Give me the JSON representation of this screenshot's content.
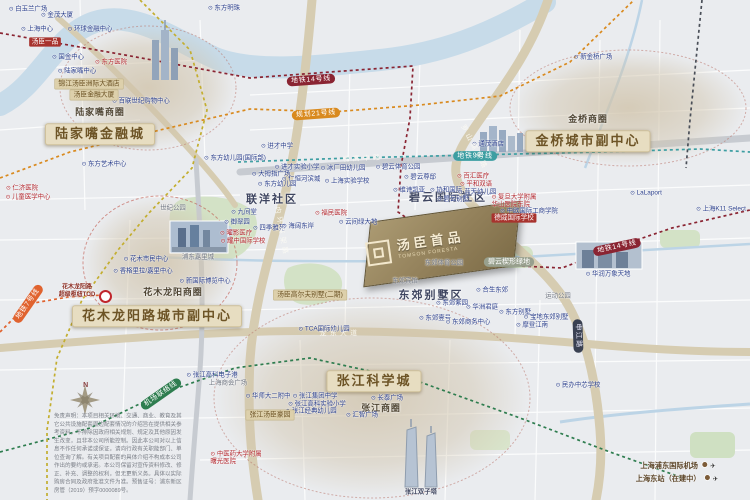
{
  "project": {
    "name_cn": "汤臣首品",
    "name_en": "TOMSON FORESTA"
  },
  "compass": {
    "n": "N"
  },
  "icons": {
    "airplane": "✈",
    "poi-dot": "⊙"
  },
  "colors": {
    "district_pill_bg": "#e7ddc1",
    "district_pill_text": "#6d5426",
    "metro_line14": "#8a2432",
    "metro_line21": "#d98a1f",
    "metro_line9": "#3d9ea2",
    "metro_line7": "#e0632f",
    "airport_link": "#2e7d4f",
    "planned_line": "#c3ae2f",
    "river": "#c7dbe9",
    "road_main": "#d6ccb1",
    "park": "#d3e2c6"
  },
  "disclaimer": "免责声明：本项目相关环境、交通、商业、教育及其它公共设施配套周边配套情况的介绍旨在提供相关参考资料，不排除因政府相关规划、规定及其他原因发生改变，且非本公司所能控制。因此本公司对以上信息不作任何承诺或保证，请向行政有关职能部门、单位查询了解。有关项目配套的具体介绍不构成本公司作出的要约或承诺。本公司保留对宣传资料修改、修正、补充、调整的权利，但无更新义务。具体以实际购房合同及政府批准文件为准。预售证号：浦东新区房管（2019）预字0000089号。",
  "metro_lines": [
    {
      "name": "地铁14号线",
      "color": "#8a2432",
      "points": [
        [
          0,
          33
        ],
        [
          125,
          55
        ],
        [
          250,
          78
        ],
        [
          330,
          72
        ],
        [
          413,
          66
        ],
        [
          410,
          118
        ],
        [
          401,
          166
        ],
        [
          398,
          212
        ],
        [
          450,
          248
        ],
        [
          520,
          266
        ],
        [
          562,
          268
        ],
        [
          616,
          247
        ],
        [
          672,
          228
        ],
        [
          750,
          210
        ]
      ]
    },
    {
      "name": "规划21号线",
      "color": "#d98a1f",
      "points": [
        [
          0,
          178
        ],
        [
          70,
          152
        ],
        [
          160,
          130
        ],
        [
          250,
          109
        ],
        [
          332,
          112
        ],
        [
          420,
          105
        ],
        [
          500,
          96
        ],
        [
          570,
          62
        ],
        [
          634,
          0
        ]
      ]
    },
    {
      "name": "地铁9号线",
      "color": "#3d9ea2",
      "points": [
        [
          238,
          162
        ],
        [
          350,
          158
        ],
        [
          474,
          155
        ],
        [
          600,
          152
        ],
        [
          700,
          149
        ],
        [
          750,
          152
        ]
      ]
    },
    {
      "name": "地铁7号线",
      "color": "#e0632f",
      "points": [
        [
          0,
          332
        ],
        [
          28,
          304
        ],
        [
          68,
          297
        ],
        [
          104,
          295
        ]
      ]
    },
    {
      "name": "机场联络线",
      "color": "#2e7d4f",
      "points": [
        [
          0,
          452
        ],
        [
          90,
          428
        ],
        [
          160,
          394
        ],
        [
          235,
          368
        ],
        [
          310,
          358
        ],
        [
          420,
          382
        ],
        [
          520,
          418
        ],
        [
          610,
          452
        ],
        [
          683,
          478
        ]
      ]
    },
    {
      "name": "规划轨交线",
      "color": "#c3ae2f",
      "points": [
        [
          140,
          0
        ],
        [
          190,
          50
        ],
        [
          207,
          110
        ],
        [
          192,
          168
        ],
        [
          148,
          214
        ],
        [
          118,
          250
        ],
        [
          82,
          300
        ],
        [
          57,
          358
        ],
        [
          47,
          430
        ],
        [
          47,
          500
        ]
      ]
    },
    {
      "name": "外环高速",
      "color": "#4a4f58",
      "points": [
        [
          702,
          0
        ],
        [
          696,
          60
        ],
        [
          690,
          120
        ],
        [
          686,
          168
        ]
      ]
    }
  ],
  "labels": [
    {
      "t": "陆家嘴金融城",
      "x": 100,
      "y": 134,
      "k": "big"
    },
    {
      "t": "金桥城市副中心",
      "x": 588,
      "y": 141,
      "k": "big"
    },
    {
      "t": "花木龙阳路城市副中心",
      "x": 157,
      "y": 316,
      "k": "big"
    },
    {
      "t": "张江科学城",
      "x": 374,
      "y": 381,
      "k": "big"
    },
    {
      "t": "陆家嘴商圈",
      "x": 100,
      "y": 113,
      "k": "sub"
    },
    {
      "t": "金桥商圈",
      "x": 588,
      "y": 120,
      "k": "sub"
    },
    {
      "t": "花木龙阳商圈",
      "x": 173,
      "y": 293,
      "k": "sub"
    },
    {
      "t": "张江商圈",
      "x": 381,
      "y": 409,
      "k": "sub"
    },
    {
      "t": "碧云国际社区",
      "x": 448,
      "y": 198,
      "k": "area"
    },
    {
      "t": "联洋社区",
      "x": 272,
      "y": 200,
      "k": "area"
    },
    {
      "t": "东郊别墅区",
      "x": 431,
      "y": 296,
      "k": "area"
    },
    {
      "t": "白玉兰广场",
      "x": 28,
      "y": 9,
      "k": "blue"
    },
    {
      "t": "东方明珠",
      "x": 224,
      "y": 8,
      "k": "blue"
    },
    {
      "t": "金茂大厦",
      "x": 57,
      "y": 15,
      "k": "blue"
    },
    {
      "t": "上海中心",
      "x": 37,
      "y": 29,
      "k": "blue"
    },
    {
      "t": "环球金融中心",
      "x": 90,
      "y": 29,
      "k": "blue"
    },
    {
      "t": "国金中心",
      "x": 68,
      "y": 57,
      "k": "blue"
    },
    {
      "t": "陆家嘴中心",
      "x": 77,
      "y": 71,
      "k": "blue"
    },
    {
      "t": "百联世纪购物中心",
      "x": 141,
      "y": 101,
      "k": "blue"
    },
    {
      "t": "东方艺术中心",
      "x": 104,
      "y": 164,
      "k": "blue"
    },
    {
      "t": "进才中学",
      "x": 277,
      "y": 146,
      "k": "blue"
    },
    {
      "t": "东方幼儿园(国际部)",
      "x": 235,
      "y": 158,
      "k": "blue"
    },
    {
      "t": "进才实验小学",
      "x": 297,
      "y": 167,
      "k": "blue"
    },
    {
      "t": "大拇指广场",
      "x": 271,
      "y": 174,
      "k": "blue"
    },
    {
      "t": "仁恒河滨城",
      "x": 301,
      "y": 179,
      "k": "blue"
    },
    {
      "t": "东方幼儿园",
      "x": 277,
      "y": 184,
      "k": "blue"
    },
    {
      "t": "冰厂田幼儿园",
      "x": 343,
      "y": 168,
      "k": "blue"
    },
    {
      "t": "上海实验学校",
      "x": 347,
      "y": 181,
      "k": "blue"
    },
    {
      "t": "碧云体育公园",
      "x": 398,
      "y": 167,
      "k": "blue"
    },
    {
      "t": "碧云尊邸",
      "x": 420,
      "y": 177,
      "k": "blue"
    },
    {
      "t": "维诗凯亚",
      "x": 409,
      "y": 190,
      "k": "blue"
    },
    {
      "t": "协和国际",
      "x": 446,
      "y": 190,
      "k": "blue"
    },
    {
      "t": "蓝天幼儿园",
      "x": 477,
      "y": 192,
      "k": "blue"
    },
    {
      "t": "九间堂",
      "x": 244,
      "y": 212,
      "k": "blue"
    },
    {
      "t": "御翠园",
      "x": 237,
      "y": 222,
      "k": "blue"
    },
    {
      "t": "四季雅苑",
      "x": 269,
      "y": 228,
      "k": "blue"
    },
    {
      "t": "海阔东岸",
      "x": 298,
      "y": 226,
      "k": "blue"
    },
    {
      "t": "云间绿大地",
      "x": 358,
      "y": 222,
      "k": "blue"
    },
    {
      "t": "碧云别墅",
      "x": 453,
      "y": 199,
      "k": "blue"
    },
    {
      "t": "中欧国际工商学院",
      "x": 529,
      "y": 211,
      "k": "blue"
    },
    {
      "t": "LaLaport",
      "x": 646,
      "y": 193,
      "k": "blue"
    },
    {
      "t": "上海K11 Select",
      "x": 721,
      "y": 209,
      "k": "blue"
    },
    {
      "t": "新金桥广场",
      "x": 593,
      "y": 57,
      "k": "blue"
    },
    {
      "t": "通茂酒店",
      "x": 488,
      "y": 144,
      "k": "blue"
    },
    {
      "t": "华润万象天地",
      "x": 608,
      "y": 274,
      "k": "blue"
    },
    {
      "t": "东郊商务中心",
      "x": 468,
      "y": 322,
      "k": "blue"
    },
    {
      "t": "东郊紫园",
      "x": 452,
      "y": 303,
      "k": "blue"
    },
    {
      "t": "合生东郊",
      "x": 492,
      "y": 290,
      "k": "blue"
    },
    {
      "t": "华洲君庭",
      "x": 482,
      "y": 307,
      "k": "blue"
    },
    {
      "t": "东郊壹号",
      "x": 435,
      "y": 318,
      "k": "blue"
    },
    {
      "t": "东方别墅",
      "x": 515,
      "y": 312,
      "k": "blue"
    },
    {
      "t": "宝地东郊别墅",
      "x": 546,
      "y": 317,
      "k": "blue"
    },
    {
      "t": "摩登江南",
      "x": 532,
      "y": 325,
      "k": "blue"
    },
    {
      "t": "长泰广场",
      "x": 387,
      "y": 398,
      "k": "blue"
    },
    {
      "t": "张江高科电子港",
      "x": 212,
      "y": 375,
      "k": "blue"
    },
    {
      "t": "华师大二附中",
      "x": 268,
      "y": 396,
      "k": "blue"
    },
    {
      "t": "张江集团中学",
      "x": 315,
      "y": 396,
      "k": "blue"
    },
    {
      "t": "张江高科实验小学",
      "x": 317,
      "y": 404,
      "k": "blue"
    },
    {
      "t": "张江经典幼儿园",
      "x": 311,
      "y": 411,
      "k": "blue"
    },
    {
      "t": "汇智广场",
      "x": 362,
      "y": 415,
      "k": "blue"
    },
    {
      "t": "民办中芯学校",
      "x": 578,
      "y": 385,
      "k": "blue"
    },
    {
      "t": "TCA国际幼儿园",
      "x": 324,
      "y": 329,
      "k": "blue"
    },
    {
      "t": "新国际博览中心",
      "x": 205,
      "y": 281,
      "k": "blue"
    },
    {
      "t": "香格里拉/嘉里中心",
      "x": 143,
      "y": 271,
      "k": "blue"
    },
    {
      "t": "花木市民中心",
      "x": 146,
      "y": 259,
      "k": "blue"
    },
    {
      "t": "上海商会广场",
      "x": 228,
      "y": 383,
      "k": "gray"
    },
    {
      "t": "世纪公园",
      "x": 173,
      "y": 208,
      "k": "gray"
    },
    {
      "t": "浦东嘉里城",
      "x": 198,
      "y": 257,
      "k": "gray"
    },
    {
      "t": "东郊宾馆",
      "x": 405,
      "y": 281,
      "k": "gray"
    },
    {
      "t": "东郊体育公园",
      "x": 444,
      "y": 263,
      "k": "gray"
    },
    {
      "t": "运动公园",
      "x": 558,
      "y": 296,
      "k": "gray"
    },
    {
      "t": "汤臣一品",
      "x": 45,
      "y": 42,
      "k": "redpill"
    },
    {
      "t": "东方医院",
      "x": 111,
      "y": 62,
      "k": "red"
    },
    {
      "t": "仁济医院",
      "x": 22,
      "y": 188,
      "k": "red"
    },
    {
      "t": "儿童医学中心",
      "x": 28,
      "y": 197,
      "k": "red"
    },
    {
      "t": "曜影医疗",
      "x": 236,
      "y": 233,
      "k": "red"
    },
    {
      "t": "耀中国际学校",
      "x": 243,
      "y": 241,
      "k": "red"
    },
    {
      "t": "福民医院",
      "x": 331,
      "y": 213,
      "k": "red"
    },
    {
      "t": "百汇医疗",
      "x": 473,
      "y": 176,
      "k": "red"
    },
    {
      "t": "平和双语",
      "x": 476,
      "y": 184,
      "k": "red"
    },
    {
      "t": "复旦大学附属\n华山医院东院",
      "x": 514,
      "y": 201,
      "k": "red"
    },
    {
      "t": "德威国际学校",
      "x": 514,
      "y": 218,
      "k": "redpill"
    },
    {
      "t": "中医药大学附属\n曙光医院",
      "x": 236,
      "y": 458,
      "k": "red"
    },
    {
      "t": "锦江汤臣洲际大酒店",
      "x": 89,
      "y": 84,
      "k": "tan"
    },
    {
      "t": "汤臣金融大厦",
      "x": 94,
      "y": 95,
      "k": "tan"
    },
    {
      "t": "汤臣高尔夫别墅(二期)",
      "x": 310,
      "y": 295,
      "k": "tan"
    },
    {
      "t": "张江汤臣豪园",
      "x": 270,
      "y": 415,
      "k": "tan"
    },
    {
      "t": "碧云楔形绿地",
      "x": 509,
      "y": 262,
      "k": "graypill"
    },
    {
      "t": "申江路",
      "x": 578,
      "y": 336,
      "k": "navpill",
      "r": 88
    },
    {
      "t": "地铁14号线",
      "x": 311,
      "y": 80,
      "k": "metro",
      "r": -4,
      "bg": "#8a2432"
    },
    {
      "t": "地铁14号线",
      "x": 617,
      "y": 247,
      "k": "metro",
      "r": -12,
      "bg": "#8a2432"
    },
    {
      "t": "规划21号线",
      "x": 316,
      "y": 114,
      "k": "metro",
      "r": -4,
      "bg": "#d98a1f"
    },
    {
      "t": "地铁9号线",
      "x": 475,
      "y": 156,
      "k": "metro",
      "r": 0,
      "bg": "#3d9ea2"
    },
    {
      "t": "地铁7号线",
      "x": 28,
      "y": 304,
      "k": "metro",
      "r": -55,
      "bg": "#e0632f"
    },
    {
      "t": "机场联络线",
      "x": 161,
      "y": 394,
      "k": "metro",
      "r": -35,
      "bg": "#2e7d4f"
    },
    {
      "t": "花木龙阳路\n超级枢纽TOD",
      "x": 77,
      "y": 291,
      "k": "tod"
    },
    {
      "t": "内环高架路",
      "x": 281,
      "y": 232,
      "k": "road",
      "r": 80
    },
    {
      "t": "罗山高架路",
      "x": 474,
      "y": 148,
      "k": "road",
      "r": 62
    },
    {
      "t": "龙东大道",
      "x": 340,
      "y": 334,
      "k": "road",
      "r": -1
    },
    {
      "t": "杨高中路",
      "x": 363,
      "y": 159,
      "k": "road",
      "r": -3
    },
    {
      "t": "张江双子塔",
      "x": 421,
      "y": 492,
      "k": "cap"
    },
    {
      "t": "上海浦东国际机场",
      "x": 678,
      "y": 466,
      "k": "airport"
    },
    {
      "t": "上海东站（在建中）",
      "x": 677,
      "y": 479,
      "k": "airport"
    }
  ]
}
